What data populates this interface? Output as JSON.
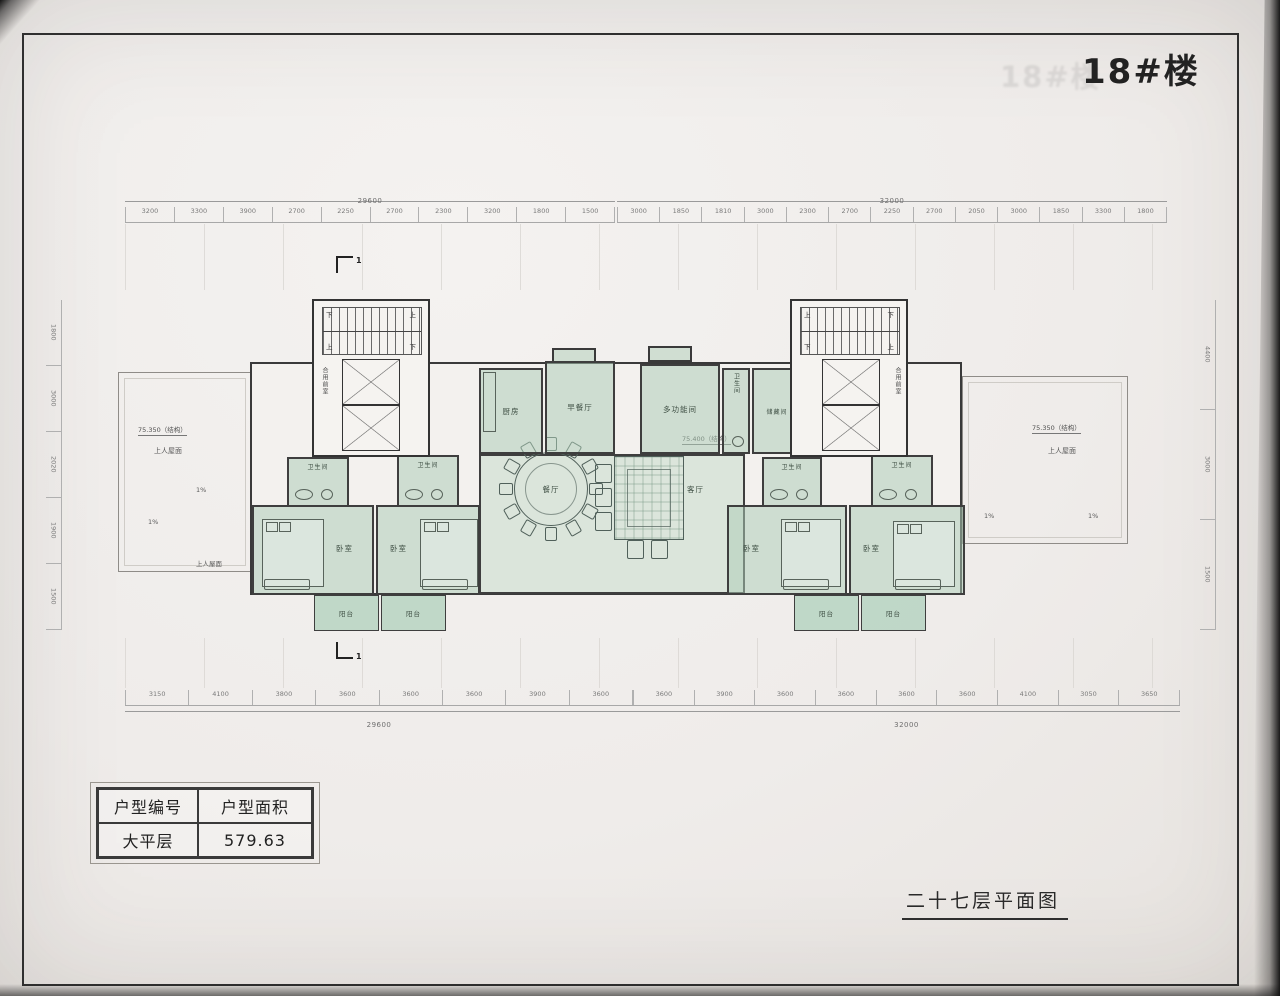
{
  "title": "18#楼",
  "caption": "二十七层平面图",
  "unit_table": {
    "header": [
      "户型编号",
      "户型面积"
    ],
    "row": [
      "大平层",
      "579.63"
    ]
  },
  "dimensions": {
    "top_overall_left": "29600",
    "top_overall_right": "32000",
    "bottom_overall_left": "29600",
    "bottom_overall_right": "32000",
    "top_left_segments": [
      "3200",
      "3300",
      "3900",
      "2700",
      "2250",
      "2700",
      "2300",
      "3200",
      "1800",
      "1500"
    ],
    "top_right_segments": [
      "3000",
      "1850",
      "1810",
      "3000",
      "2300",
      "2700",
      "2250",
      "2700",
      "2050",
      "3000",
      "1850",
      "3300",
      "1800"
    ],
    "bottom_left_segments": [
      "3150",
      "4100",
      "3800",
      "3600",
      "3600",
      "3600",
      "3900",
      "3600"
    ],
    "bottom_right_segments": [
      "3600",
      "3900",
      "3600",
      "3600",
      "3600",
      "3600",
      "4100",
      "3050",
      "3650"
    ],
    "left_side_segments": [
      "1800",
      "3000",
      "2020",
      "1900",
      "1500"
    ],
    "right_side_segments": [
      "4400",
      "3000",
      "1500"
    ]
  },
  "levels": {
    "roof_left": "75.350（结构）",
    "roof_right": "75.350（结构）",
    "hall": "75.400（结构）",
    "roof_area": "上人屋面",
    "slope": "1%"
  },
  "rooms": {
    "kitchen": "厨房",
    "breakfast": "早餐厅",
    "dining": "餐厅",
    "living": "客厅",
    "multi": "多功能间",
    "bath": "卫生间",
    "storage": "储藏间",
    "bedroom": "卧室",
    "balcony": "阳台",
    "shared_lobby": "合用前室",
    "up": "上",
    "down": "下"
  },
  "marks": {
    "section": "1"
  },
  "colors": {
    "room_fill": "#adccb6",
    "balcony_fill": "#98c6ac",
    "wall": "#3a3a3a",
    "paper": "#f1efec"
  }
}
